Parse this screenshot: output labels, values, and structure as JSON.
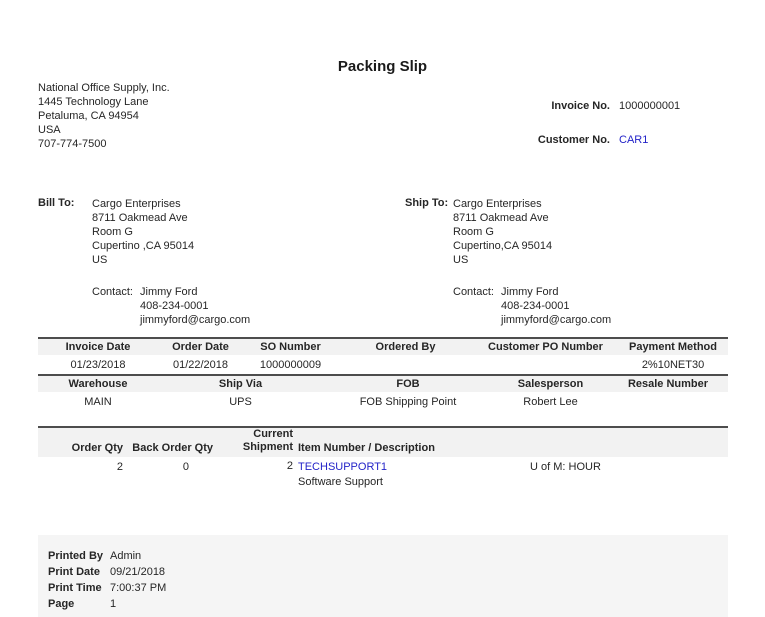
{
  "title": "Packing Slip",
  "colors": {
    "link_blue": "#2323C8",
    "table_header_bg": "#F2F2F2",
    "footer_bg": "#F5F5F5",
    "rule_dark": "#4D4D4D"
  },
  "company": {
    "name": "National Office Supply, Inc.",
    "address_lines": [
      "1445 Technology Lane",
      "Petaluma, CA 94954",
      "USA",
      "707-774-7500"
    ]
  },
  "refs": {
    "invoice_label": "Invoice No.",
    "invoice_value": "1000000001",
    "customer_label": "Customer No.",
    "customer_value": "CAR1"
  },
  "bill_to": {
    "label": "Bill To:",
    "lines": [
      "Cargo Enterprises",
      "8711 Oakmead Ave",
      "Room G",
      "Cupertino ,CA 95014",
      "US"
    ],
    "contact_label": "Contact:",
    "contact_name": "Jimmy Ford",
    "contact_phone": "408-234-0001",
    "contact_email": "jimmyford@cargo.com"
  },
  "ship_to": {
    "label": "Ship To:",
    "lines": [
      "Cargo Enterprises",
      "8711 Oakmead Ave",
      "Room G",
      "Cupertino,CA 95014",
      "US"
    ],
    "contact_label": "Contact:",
    "contact_name": "Jimmy Ford",
    "contact_phone": "408-234-0001",
    "contact_email": "jimmyford@cargo.com"
  },
  "order_info": {
    "row1": {
      "headers": [
        "Invoice Date",
        "Order Date",
        "SO Number",
        "Ordered By",
        "Customer PO Number",
        "Payment Method"
      ],
      "values": [
        "01/23/2018",
        "01/22/2018",
        "1000000009",
        "",
        "",
        "2%10NET30"
      ]
    },
    "row2": {
      "headers": [
        "Warehouse",
        "Ship Via",
        "FOB",
        "Salesperson",
        "Resale Number"
      ],
      "values": [
        "MAIN",
        "UPS",
        "FOB Shipping Point",
        "Robert Lee",
        ""
      ]
    }
  },
  "items": {
    "headers": {
      "order_qty": "Order Qty",
      "back_order_qty": "Back Order Qty",
      "current_line1": "Current",
      "current_line2": "Shipment",
      "item_description": "Item Number / Description"
    },
    "rows": [
      {
        "order_qty": "2",
        "back_order_qty": "0",
        "current_shipment": "2",
        "item_number": "TECHSUPPORT1",
        "description": "Software Support",
        "uom": "U of M: HOUR"
      }
    ]
  },
  "footer": {
    "printed_by_label": "Printed By",
    "printed_by_value": "Admin",
    "print_date_label": "Print Date",
    "print_date_value": "09/21/2018",
    "print_time_label": "Print Time",
    "print_time_value": "7:00:37 PM",
    "page_label": "Page",
    "page_value": "1"
  }
}
